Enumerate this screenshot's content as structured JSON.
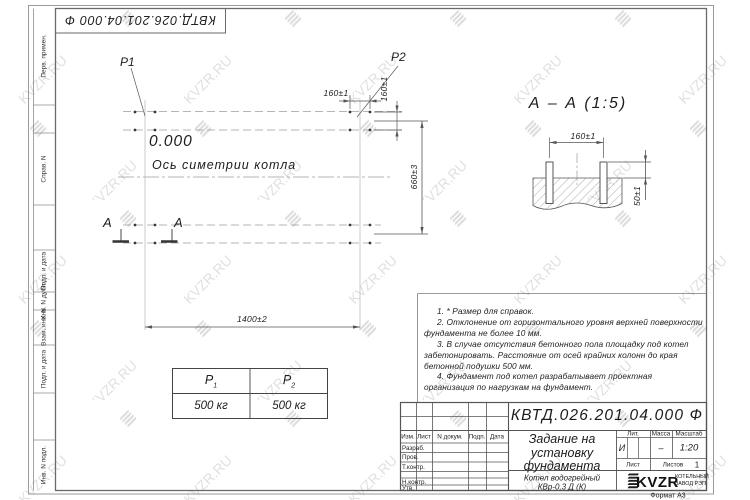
{
  "watermark": {
    "text": "KVZR.RU"
  },
  "sheet": {
    "top_stamp": "КВТД.026.201.04.000  Ф",
    "format_label": "Формат А3",
    "margin_labels": {
      "perv": "Перв. примен.",
      "sprav": "Справ. N",
      "podp1": "Подп. и дата",
      "inv_dubl": "Инв. N дубл.",
      "vzam": "Взам. инв. N",
      "podp2": "Подп. и дата",
      "inv_podl": "Инв. N подл."
    }
  },
  "plan": {
    "p1": "P1",
    "p2": "P2",
    "level": "0.000",
    "axis_label": "Ось симетрии котла",
    "section_letter": "А",
    "dim_width": "1400±2",
    "dim_height": "660±3",
    "dim_bolt_x": "160±1",
    "dim_bolt_y": "160±1"
  },
  "section_view": {
    "title": "А – А (1:5)",
    "dim_spacing": "160±1",
    "dim_protrusion": "50±1"
  },
  "load_table": {
    "col1": {
      "name": "Р",
      "sub": "1",
      "value": "500 кг"
    },
    "col2": {
      "name": "Р",
      "sub": "2",
      "value": "500 кг"
    }
  },
  "notes": [
    "1. * Размер для справок.",
    "2. Отклонение от горизонтального уровня верхней поверхности фундамента не более 10 мм.",
    "3. В случае отсутствия бетонного пола площадку под котел забетонировать. Расстояние от осей крайних колонн до края бетонной подушки 500 мм.",
    "4. Фундамент под котел разрабатывает проектная организация по нагрузкам на фундамент."
  ],
  "title_block": {
    "doc_number": "КВТД.026.201.04.000  Ф",
    "title_line1": "Задание на",
    "title_line2": "установку",
    "title_line3": "фундамента",
    "product_line1": "Котел водогрейный",
    "product_line2": "КВр-0,3 Д (К)",
    "lit_header": "Лит.",
    "mass_header": "Масса",
    "scale_header": "Масштаб",
    "lit_value": "И",
    "mass_value": "–",
    "scale_value": "1:20",
    "sheet_label": "Лист",
    "sheets_label": "Листов",
    "sheets_value": "1",
    "company_logo": "KVZR",
    "company_name1": "КОТЕЛЬНЫЙ",
    "company_name2": "ЗАВОД РЭП",
    "header_cols": {
      "izm": "Изм.",
      "list": "Лист",
      "ndoc": "N докум.",
      "podp": "Подп.",
      "data": "Дата"
    },
    "rows": {
      "razrab": "Разраб.",
      "prov": "Пров.",
      "tkontr": "Т.контр.",
      "nkontr": "Н.контр.",
      "utv": "Утв."
    }
  }
}
